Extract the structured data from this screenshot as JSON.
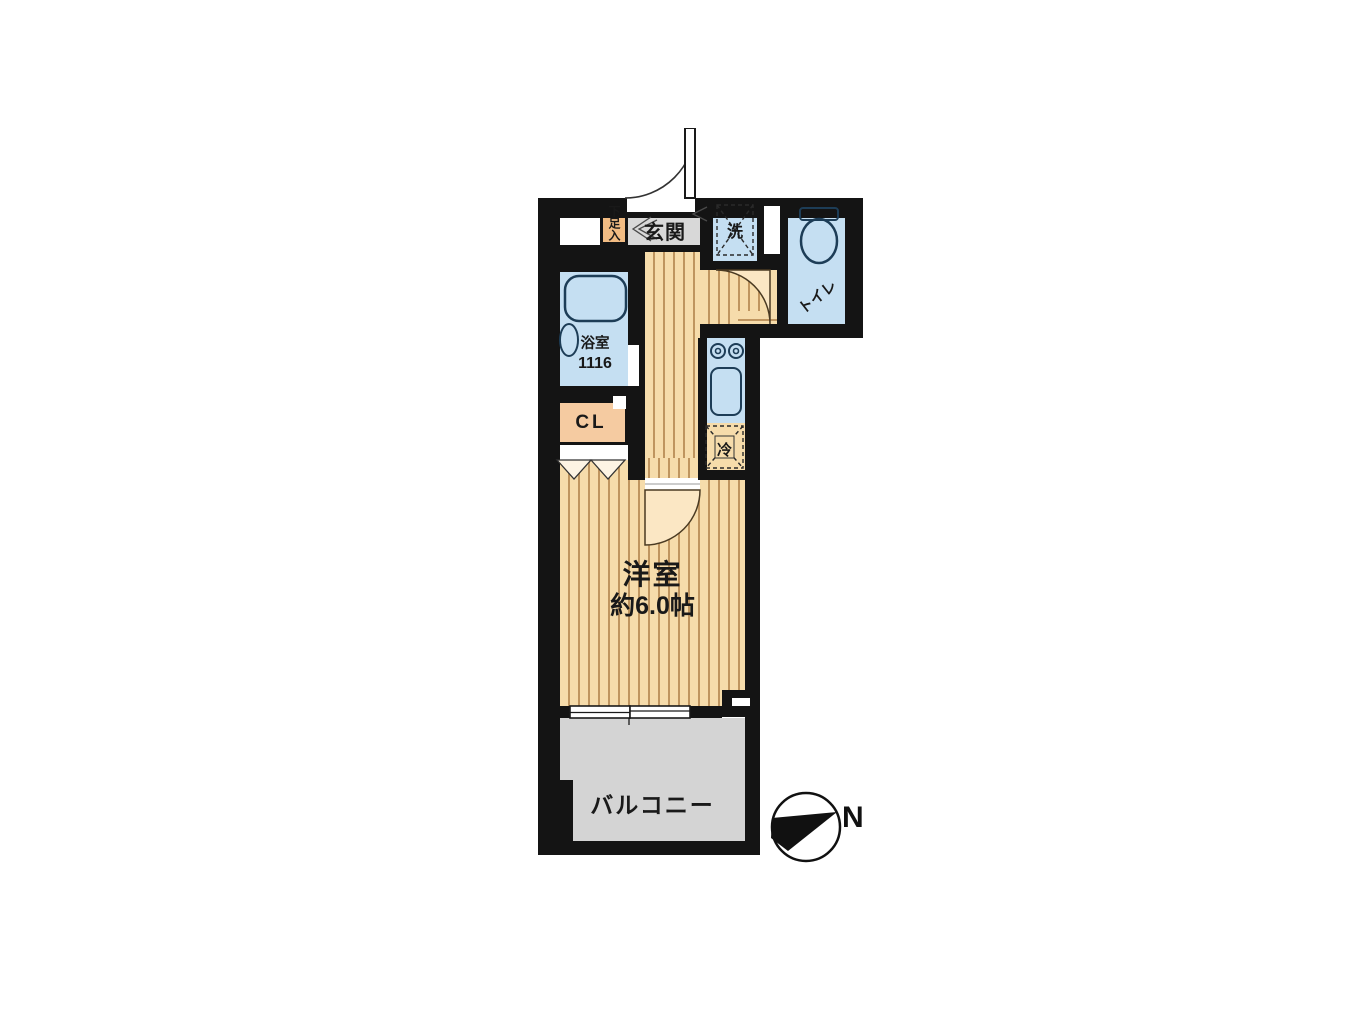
{
  "plan": {
    "rooms": {
      "entrance_label": "玄関",
      "shoe_storage_label": "下足入",
      "washer_label": "洗",
      "toilet_label": "トイレ",
      "bathroom_label": "浴室",
      "bathroom_size": "1116",
      "closet_label": "CL",
      "fridge_label": "冷",
      "room_label": "洋室",
      "room_size": "約6.0帖",
      "balcony_label": "バルコニー"
    },
    "compass": {
      "north_label": "N"
    },
    "colors": {
      "background": "#ffffff",
      "wall": "#141414",
      "floor_base": "#f6dcab",
      "floor_stripe": "#bf955f",
      "wet_area_blue": "#c5dff2",
      "fixture_stroke": "#1d3d57",
      "shoe_orange": "#f2bc83",
      "closet_orange": "#f5cba1",
      "genkan_gray": "#d8d8d8",
      "balcony_gray": "#d4d4d4",
      "door_leaf_fill": "#fbe7c4"
    }
  }
}
